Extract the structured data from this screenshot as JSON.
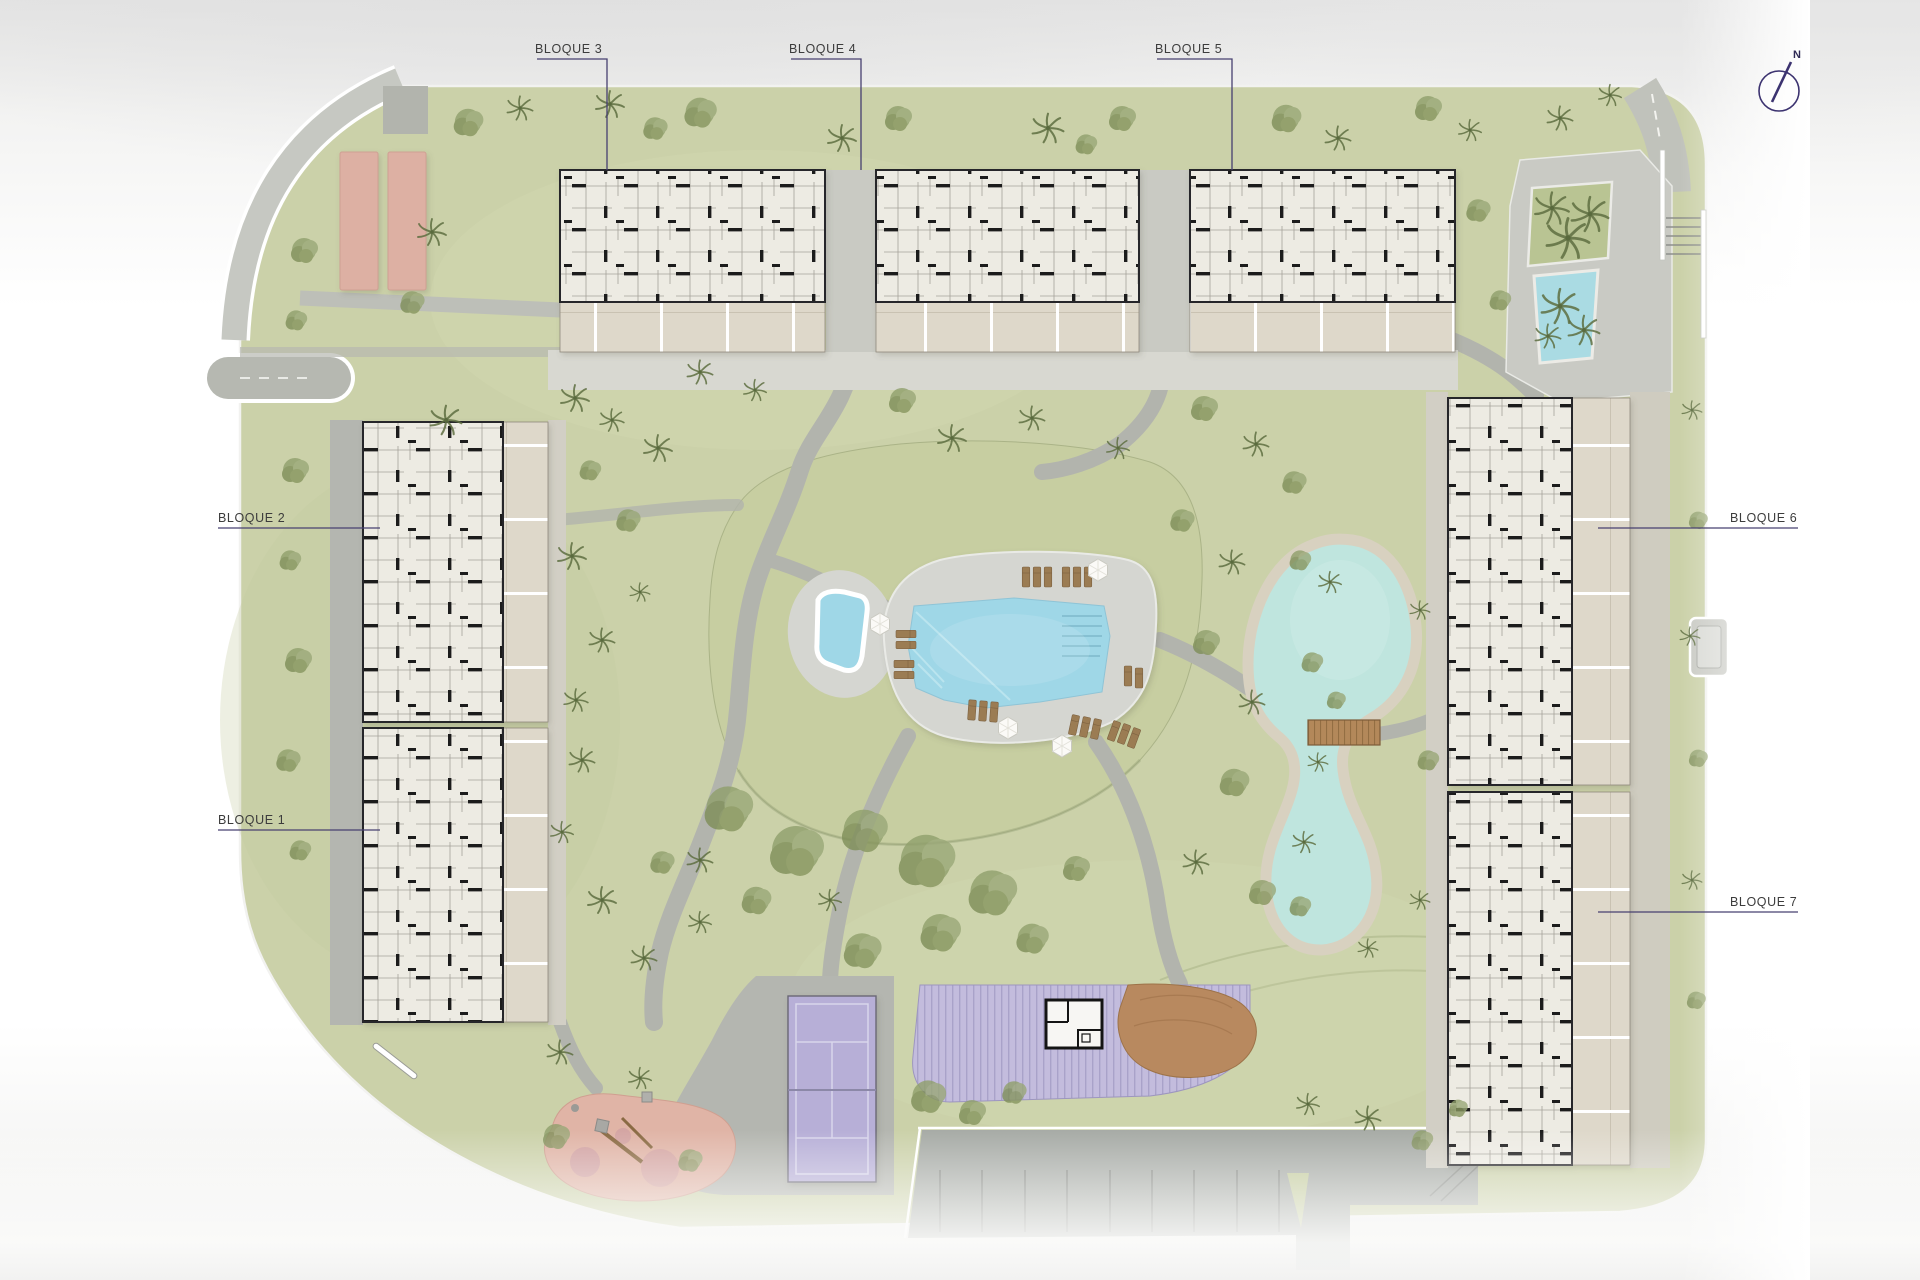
{
  "plan": {
    "title": "Residential masterplan site plan",
    "compass_label": "N",
    "blocks": {
      "b1": {
        "label": "BLOQUE 1"
      },
      "b2": {
        "label": "BLOQUE 2"
      },
      "b3": {
        "label": "BLOQUE 3"
      },
      "b4": {
        "label": "BLOQUE 4"
      },
      "b5": {
        "label": "BLOQUE 5"
      },
      "b6": {
        "label": "BLOQUE 6"
      },
      "b7": {
        "label": "BLOQUE 7"
      }
    },
    "amenities": [
      {
        "name": "main-pool"
      },
      {
        "name": "kids-pool"
      },
      {
        "name": "pool-deck"
      },
      {
        "name": "sun-loungers"
      },
      {
        "name": "umbrellas"
      },
      {
        "name": "lake"
      },
      {
        "name": "wooden-bridge"
      },
      {
        "name": "tennis-court"
      },
      {
        "name": "pergola"
      },
      {
        "name": "pool-bar"
      },
      {
        "name": "wood-deck"
      },
      {
        "name": "playground"
      },
      {
        "name": "petanque-courts"
      },
      {
        "name": "parking-lot"
      },
      {
        "name": "plaza-water-feature"
      },
      {
        "name": "planter"
      },
      {
        "name": "stairs"
      },
      {
        "name": "north-compass"
      }
    ],
    "colors": {
      "ground": "#cbd1a9",
      "mound": "#c7cea1",
      "path": "#b2b4ad",
      "walkway": "#b4b6b0",
      "deck": "#d5d6d1",
      "gravel": "#d2cfc5",
      "pool_water": "#9fd7e7",
      "lake_water": "#bfe5de",
      "lake_shore": "#d8d1c0",
      "building_fill": "#edebe3",
      "building_wall": "#1e1e1e",
      "terrace": "#ded8ca",
      "court_purple": "#b7afd7",
      "pergola_purple": "#c3bcdd",
      "playground_pink": "#e0b4a6",
      "petanque_pink": "#ddb0a3",
      "lounger_brown": "#9b7c53",
      "bridge_brown": "#b3885a",
      "label_text": "#3c3c3c",
      "leader_line": "#474070"
    }
  }
}
